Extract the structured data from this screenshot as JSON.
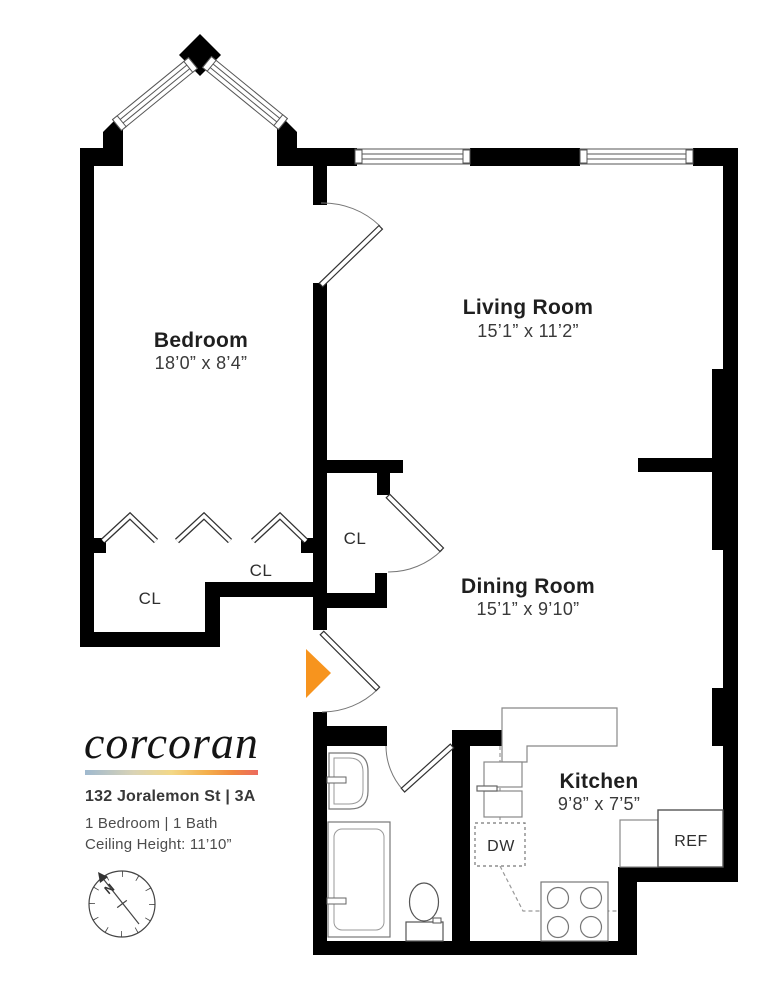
{
  "branding": {
    "logo_text": "corcoran",
    "address": "132 Joralemon St | 3A",
    "info_line_1": "1 Bedroom | 1 Bath",
    "info_line_2": "Ceiling Height: 11’10”",
    "gradient": [
      "#9fb9cf",
      "#d9d3b6",
      "#f3d887",
      "#f4b04d",
      "#f18a3e",
      "#ec6a5f"
    ]
  },
  "rooms": {
    "bedroom": {
      "name": "Bedroom",
      "dims": "18’0” x 8’4”"
    },
    "living": {
      "name": "Living Room",
      "dims": "15’1” x 11’2”"
    },
    "dining": {
      "name": "Dining Room",
      "dims": "15’1” x 9’10”"
    },
    "kitchen": {
      "name": "Kitchen",
      "dims": "9’8” x 7’5”"
    }
  },
  "labels": {
    "closet_1": "CL",
    "closet_2": "CL",
    "closet_3": "CL",
    "dishwasher": "DW",
    "refrigerator": "REF"
  },
  "compass": {
    "north": "N"
  },
  "colors": {
    "entrance_marker": "#F7941E",
    "walls": "#000000"
  }
}
